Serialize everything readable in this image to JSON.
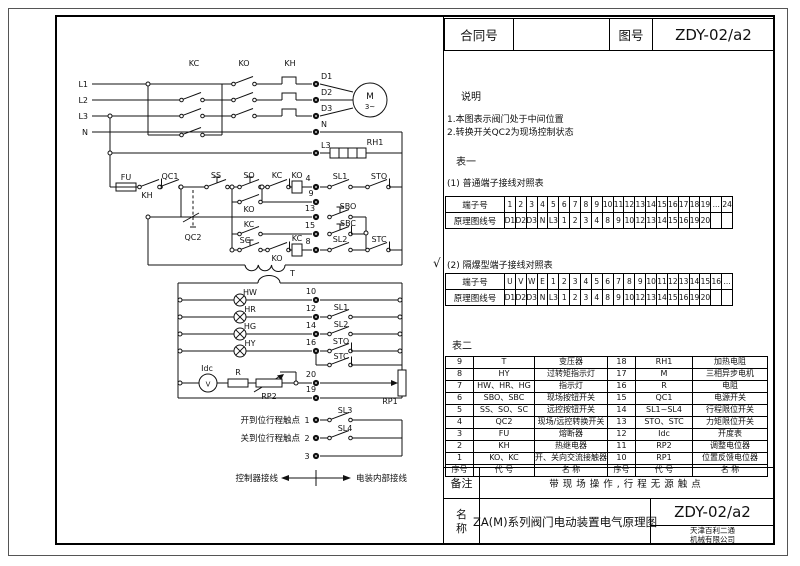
{
  "title_block": {
    "contract_label": "合同号",
    "contract_value": "",
    "drawing_label": "图号",
    "drawing_number": "ZDY-02/a2"
  },
  "notes": {
    "heading": "说明",
    "items": [
      "1.本图表示阀门处于中间位置",
      "2.转换开关QC2为现场控制状态"
    ]
  },
  "table1": {
    "heading": "表一",
    "sub1": {
      "caption": "(1)    普通端子接线对照表",
      "row1_label": "端子号",
      "row1": [
        "1",
        "2",
        "3",
        "4",
        "5",
        "6",
        "7",
        "8",
        "9",
        "10",
        "11",
        "12",
        "13",
        "14",
        "15",
        "16",
        "17",
        "18",
        "19",
        "...",
        "24"
      ],
      "row2_label": "原理图线号",
      "row2": [
        "D1",
        "D2",
        "D3",
        "N",
        "L3",
        "1",
        "2",
        "3",
        "4",
        "8",
        "9",
        "10",
        "12",
        "13",
        "14",
        "15",
        "16",
        "19",
        "20",
        "",
        ""
      ]
    },
    "sub2": {
      "checkmark": "√",
      "caption": "(2)    隔爆型端子接线对照表",
      "row1_label": "端子号",
      "row1": [
        "U",
        "V",
        "W",
        "E",
        "1",
        "2",
        "3",
        "4",
        "5",
        "6",
        "7",
        "8",
        "9",
        "10",
        "11",
        "12",
        "13",
        "14",
        "15",
        "16",
        "..."
      ],
      "row2_label": "原理图线号",
      "row2": [
        "D1",
        "D2",
        "D3",
        "N",
        "L3",
        "1",
        "2",
        "3",
        "4",
        "8",
        "9",
        "10",
        "12",
        "13",
        "14",
        "15",
        "16",
        "19",
        "20",
        "",
        ""
      ]
    }
  },
  "table2": {
    "heading": "表二",
    "rows": [
      [
        "9",
        "T",
        "变压器",
        "18",
        "RH1",
        "加热电阻"
      ],
      [
        "8",
        "HY",
        "过转矩指示灯",
        "17",
        "M",
        "三相异步电机"
      ],
      [
        "7",
        "HW、HR、HG",
        "指示灯",
        "16",
        "R",
        "电阻"
      ],
      [
        "6",
        "SBO、SBC",
        "现场按钮开关",
        "15",
        "QC1",
        "电源开关"
      ],
      [
        "5",
        "SS、SO、SC",
        "远控按钮开关",
        "14",
        "SL1~SL4",
        "行程限位开关"
      ],
      [
        "4",
        "QC2",
        "现场/远控转换开关",
        "13",
        "STO、STC",
        "力矩限位开关"
      ],
      [
        "3",
        "FU",
        "熔断器",
        "12",
        "Idc",
        "开度表"
      ],
      [
        "2",
        "KH",
        "热继电器",
        "11",
        "RP2",
        "调整电位器"
      ],
      [
        "1",
        "KO、KC",
        "开、关向交流接触器",
        "10",
        "RP1",
        "位置反馈电位器"
      ],
      [
        "序号",
        "代 号",
        "名 称",
        "序号",
        "代 号",
        "名 称"
      ]
    ]
  },
  "footer": {
    "remark_label": "备注",
    "remark_text": "带现场操作,行程无源触点",
    "name_label_1": "名",
    "name_label_2": "称",
    "name_value": "ZA(M)系列阀门电动装置电气原理图",
    "drawing_number": "ZDY-02/a2",
    "company_line1": "天津百利二通",
    "company_line2": "机械有限公司"
  },
  "circuit": {
    "l1": "L1",
    "l2": "L2",
    "l3": "L3",
    "n": "N",
    "kc": "KC",
    "ko": "KO",
    "kh": "KH",
    "d1": "D1",
    "d2": "D2",
    "d3": "D3",
    "n_term": "N",
    "l3_term": "L3",
    "rh1": "RH1",
    "motor": "M",
    "motor_phase": "3~",
    "fu": "FU",
    "kh_contact": "KH",
    "qc1": "QC1",
    "ss": "SS",
    "qc2": "QC2",
    "so": "SO",
    "ko_aux": "KO",
    "kc_aux": "KC",
    "sc": "SC",
    "kc_interlock": "KC",
    "ko_coil": "KO",
    "ko_interlock": "KO",
    "kc_coil": "KC",
    "t4": "4",
    "t9": "9",
    "t13": "13",
    "t15": "15",
    "t8": "8",
    "sl1": "SL1",
    "sto": "STO",
    "sbo": "SBO",
    "sbc": "SBC",
    "sl2": "SL2",
    "stc": "STC",
    "transformer": "T",
    "hw": "HW",
    "hr": "HR",
    "hg": "HG",
    "hy": "HY",
    "t10": "10",
    "t12": "12",
    "t14": "14",
    "t16": "16",
    "sl1_lamp": "SL1",
    "sl2_lamp": "SL2",
    "sto_lamp": "STO",
    "stc_lamp": "STC",
    "idc": "Idc",
    "meter_v": "V",
    "r": "R",
    "rp2": "RP2",
    "t20": "20",
    "t19": "19",
    "rp1": "RP1",
    "open_limit_label": "开到位行程触点",
    "close_limit_label": "关到位行程触点",
    "t1": "1",
    "t2": "2",
    "t3": "3",
    "sl3": "SL3",
    "sl4": "SL4",
    "legend_left": "控制器接线",
    "legend_right": "电装内部接线"
  }
}
